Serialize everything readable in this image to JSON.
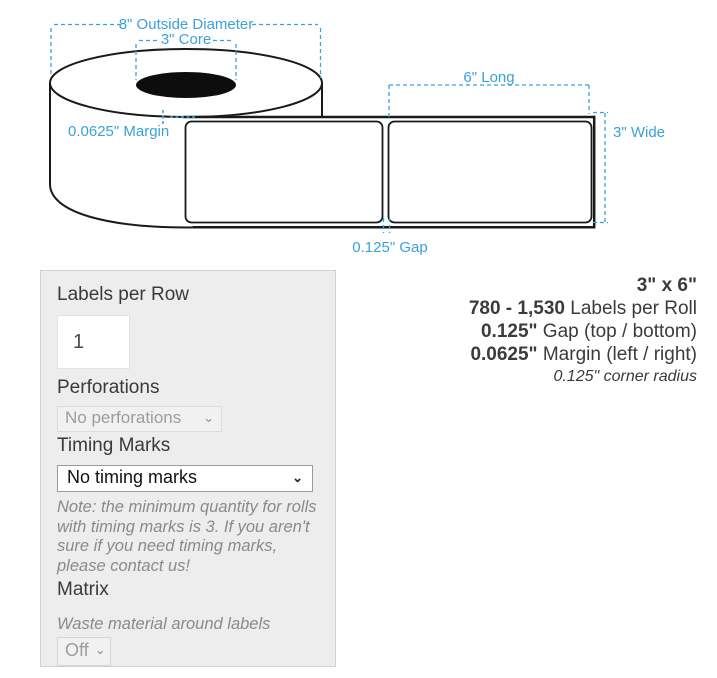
{
  "colors": {
    "accent_blue": "#3aa1db",
    "ink": "#1a1a1a",
    "text": "#3b3b3b",
    "muted": "#8a8a8a",
    "panel_bg": "#ededed"
  },
  "icons": {
    "chevron_down": "⌄"
  },
  "diagram": {
    "outside_diameter_label": "8\" Outside Diameter",
    "core_label": "3\" Core",
    "margin_label": "0.0625\" Margin",
    "long_label": "6\" Long",
    "wide_label": "3\" Wide",
    "gap_label": "0.125\" Gap"
  },
  "form": {
    "labels_per_row": {
      "label": "Labels per Row",
      "value": "1"
    },
    "perforations": {
      "label": "Perforations",
      "selected": "No perforations"
    },
    "timing_marks": {
      "label": "Timing Marks",
      "selected": "No timing marks",
      "note": "Note: the minimum quantity for rolls with timing marks is 3. If you aren't sure if you need timing marks, please contact us!"
    },
    "matrix": {
      "label": "Matrix",
      "description": "Waste material around labels",
      "selected": "Off"
    }
  },
  "summary": {
    "size": "3\" x 6\"",
    "labels_per_roll_value": "780 - 1,530",
    "labels_per_roll_text": " Labels per Roll",
    "gap_value": "0.125\"",
    "gap_text": " Gap (top / bottom)",
    "margin_value": "0.0625\"",
    "margin_text": " Margin (left / right)",
    "corner_radius": "0.125\" corner radius"
  }
}
